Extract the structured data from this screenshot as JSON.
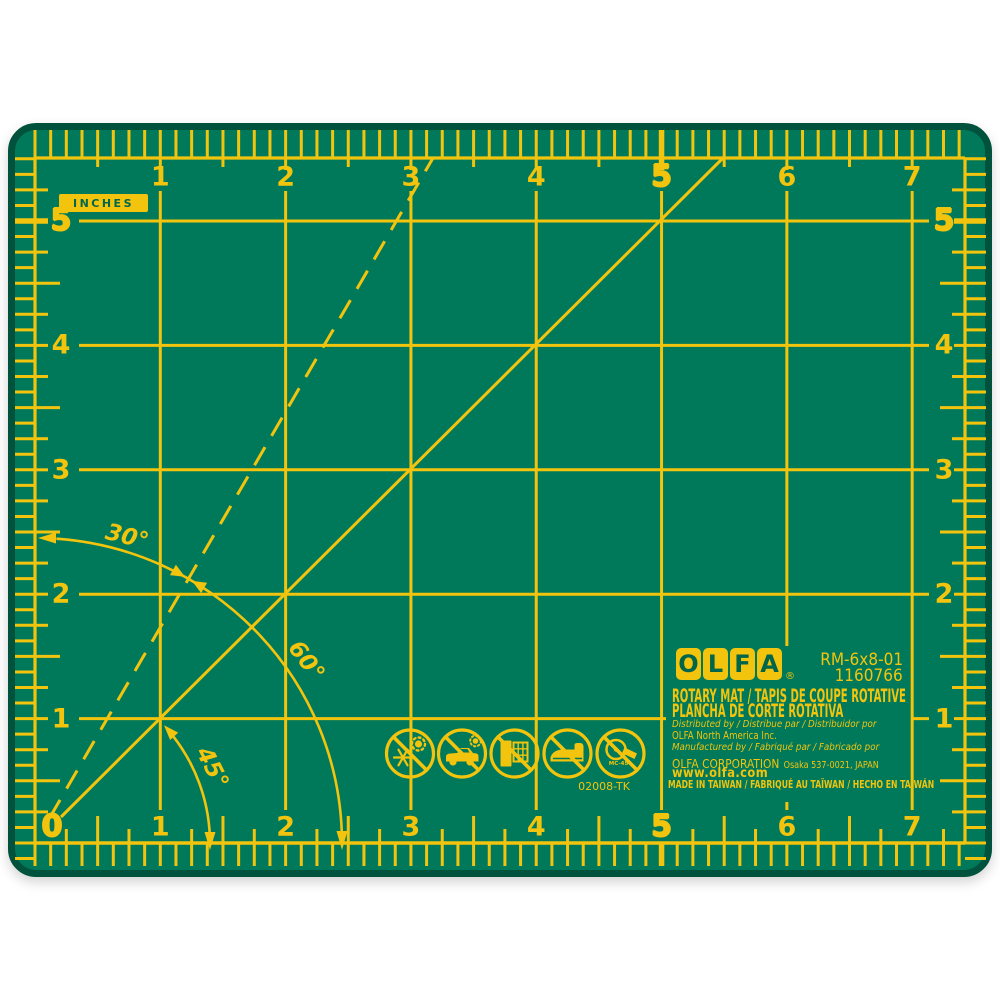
{
  "colors": {
    "mat_surface": "#00795B",
    "mat_edge": "#00523C",
    "marking_yellow": "#F2C40E",
    "background": "#FFFFFF"
  },
  "rulers": {
    "unit_label": "INCHES",
    "top": [
      "1",
      "2",
      "3",
      "4",
      "5",
      "6",
      "7"
    ],
    "bottom": [
      "0",
      "1",
      "2",
      "3",
      "4",
      "5",
      "6",
      "7"
    ],
    "left": [
      "5",
      "4",
      "3",
      "2",
      "1"
    ],
    "right": [
      "5",
      "4",
      "3",
      "2",
      "1"
    ],
    "emphasized": [
      "0",
      "5"
    ]
  },
  "angle_labels": {
    "deg30": "30°",
    "deg45": "45°",
    "deg60": "60°"
  },
  "branding": {
    "logo_letters": [
      "O",
      "L",
      "F",
      "A"
    ],
    "registered_mark": "®",
    "model": "RM-6x8-01",
    "item_number": "1160766",
    "product_name_en_fr": "ROTARY MAT / TAPIS DE COUPE ROTATIVE",
    "product_name_es": "PLANCHA DE CORTE ROTATIVA",
    "distributed_by": "Distributed by / Distribue par / Distribuidor por",
    "distributor": "OLFA North America Inc.",
    "manufactured_by": "Manufactured by / Fabriqué par / Fabricado por",
    "manufacturer": "OLFA CORPORATION",
    "manufacturer_address": "Osaka 537-0021, JAPAN",
    "website": "www.olfa.com",
    "made_in": "MADE IN TAIWAN / FABRIQUÉ AU TAÏWAN / HECHO EN TAIWÁN"
  },
  "part_code": "02008-TK",
  "care_icons": [
    {
      "name": "no-extreme-temperature-icon"
    },
    {
      "name": "no-hot-car-icon"
    },
    {
      "name": "no-window-sunlight-icon"
    },
    {
      "name": "no-ironing-icon"
    },
    {
      "name": "no-rotary-cutter-icon",
      "label": "MC-45"
    }
  ]
}
